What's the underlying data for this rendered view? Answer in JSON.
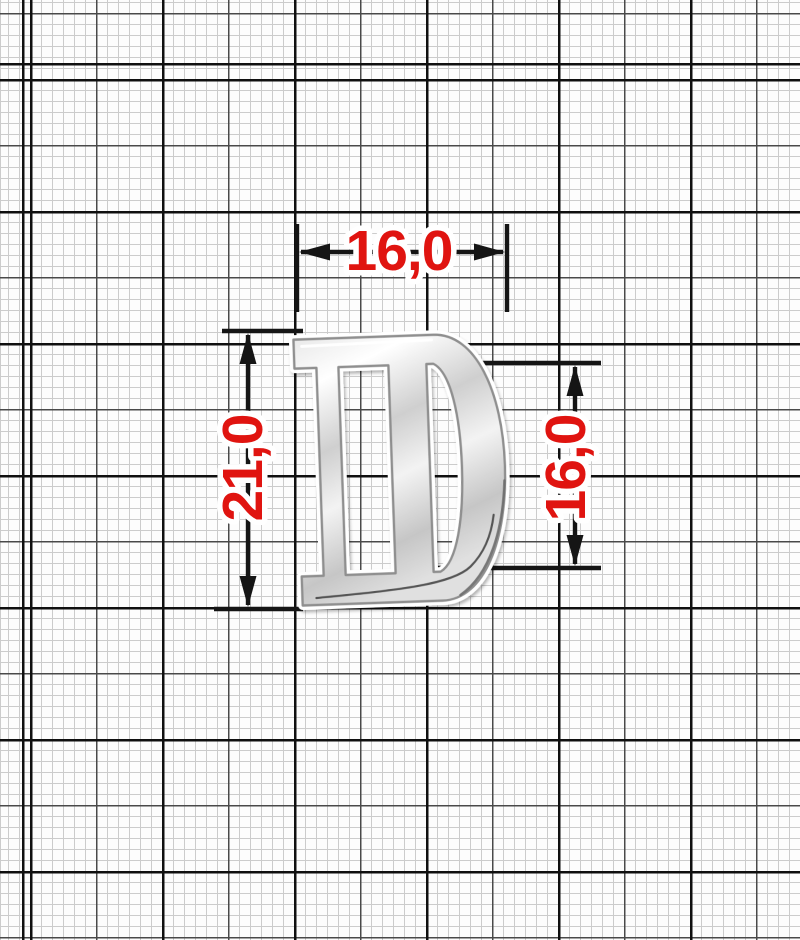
{
  "drawing": {
    "object": "chrome-letter-D-buckle",
    "background": "millimeter-graph-paper",
    "dimensions": {
      "top_width_mm": "16,0",
      "left_height_mm": "21,0",
      "right_inner_height_mm": "16,0"
    },
    "colors": {
      "dimension_text": "#e01410",
      "dimension_lines": "#151515",
      "metal_base": "#d9d9d9",
      "paper": "#fdfdfd",
      "grid_fine": "#cccccc",
      "grid_medium": "#4a4a4a",
      "grid_heavy": "#101010"
    }
  }
}
